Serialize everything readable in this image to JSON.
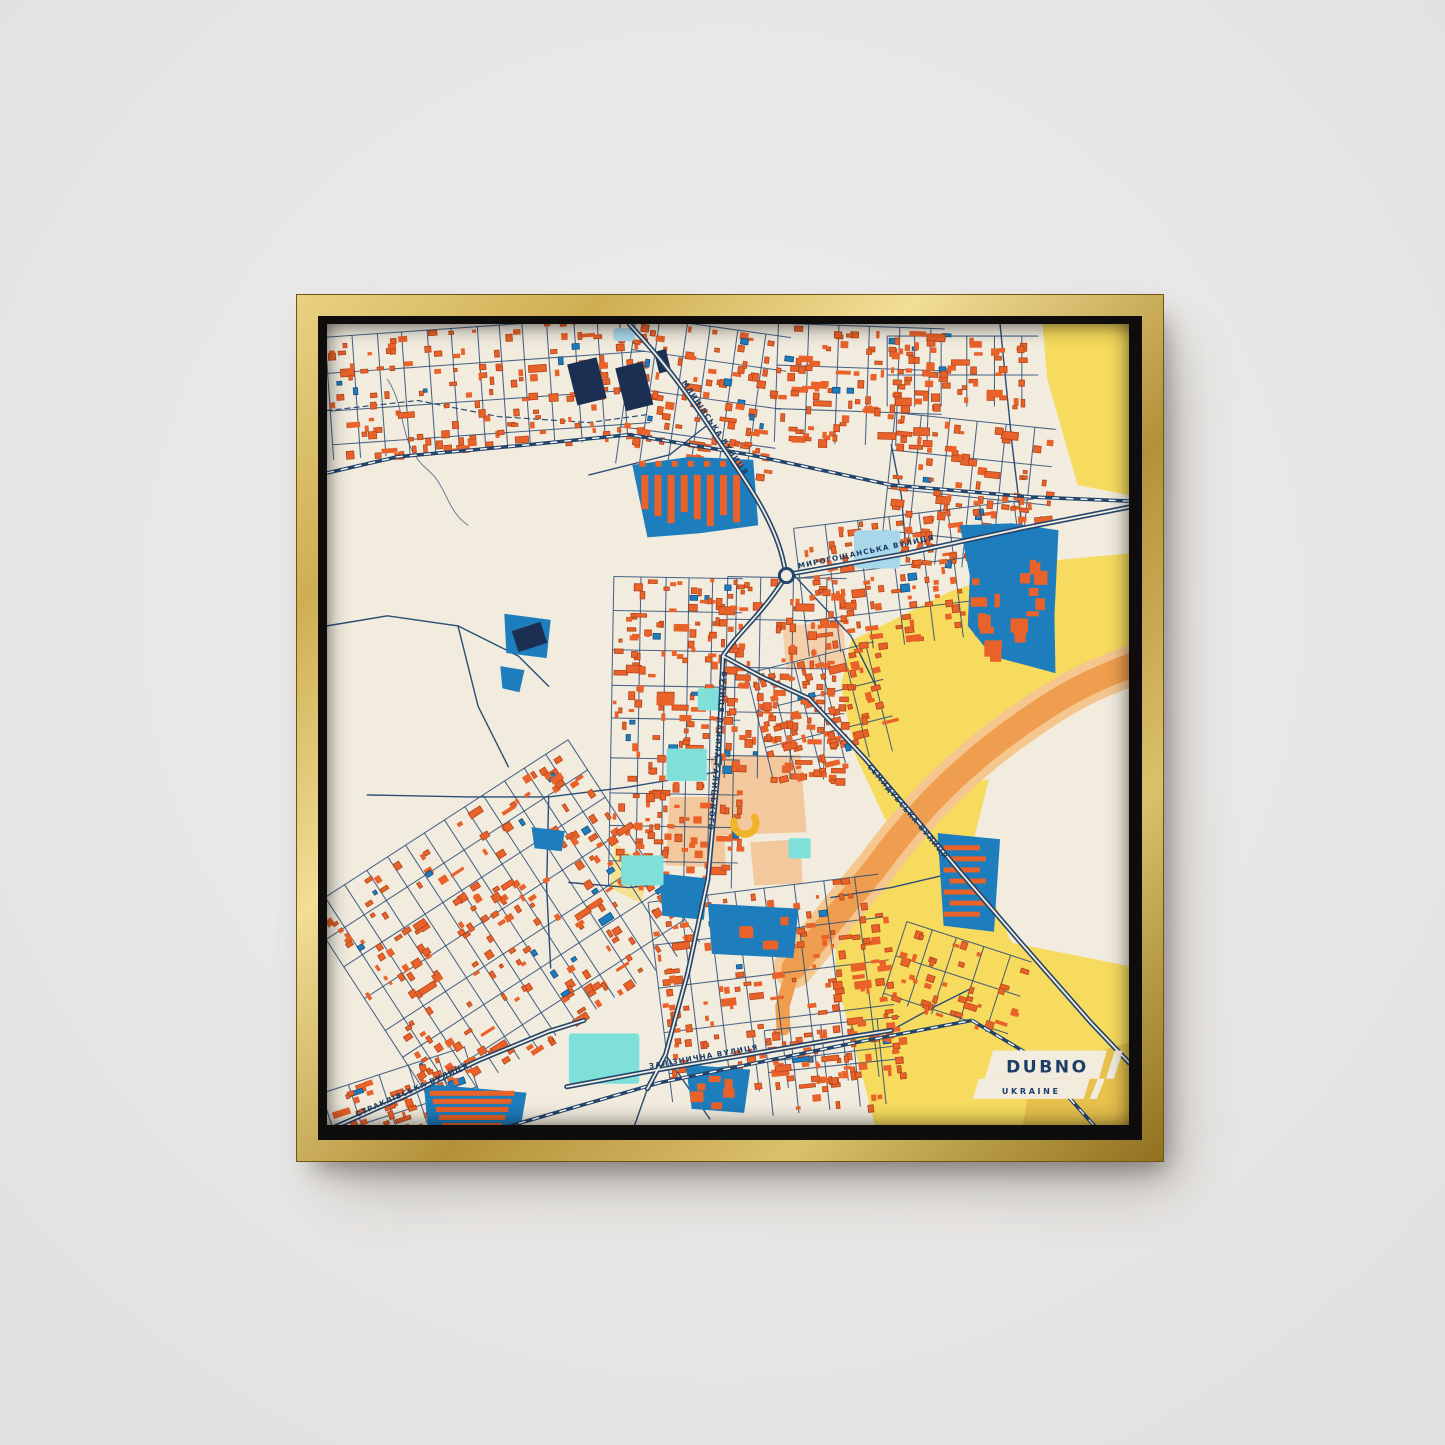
{
  "mockup": {
    "wall_color": "#eae8e6",
    "frame_color_light": "#f2de96",
    "frame_color_dark": "#8f711f",
    "floater_color": "#0e0d0b"
  },
  "map": {
    "title_plaque": {
      "city": "DUBNO",
      "country": "UKRAINE"
    },
    "street_labels": [
      {
        "id": "mlynivska",
        "text": "МЛИНІВСЬКА ВУЛИЦЯ"
      },
      {
        "id": "myrohoshchanska",
        "text": "МИРОГОЩАНСЬКА ВУЛИЦЯ"
      },
      {
        "id": "danyla-halytskoho",
        "text": "ВУЛИЦЯ ДАНИЛА ГАЛИЦЬКОГО"
      },
      {
        "id": "semydubska",
        "text": "СЕМИДУБСЬКА ВУЛИЦЯ"
      },
      {
        "id": "zaliznychna",
        "text": "ЗАЛІЗНИЧНА ВУЛИЦЯ"
      },
      {
        "id": "straklivska",
        "text": "СТРАКЛІВСЬКА ВУЛИЦЯ"
      }
    ],
    "colors": {
      "background": "#f2ecdf",
      "buildings": "#e8622a",
      "buildings_shadow": "#b5461a",
      "industrial": "#1e7dbd",
      "industrial_dark": "#174f7c",
      "navy_building": "#1b2f52",
      "farmland": "#f6db5e",
      "farmland_dark": "#e7c24c",
      "water": "#a9d7ea",
      "park": "#7fe0da",
      "peach": "#f3c89c",
      "gold_arc": "#f0b429",
      "roads": "#2c4d76",
      "roads_major": "#24456b",
      "road_fill": "#f2ecdf",
      "highway": "#ef9d4e",
      "highway_casing": "#f5c68e",
      "rail_dash": "#ffffff",
      "label_text": "#1c3c64",
      "plaque": "#f2ecdf"
    }
  }
}
